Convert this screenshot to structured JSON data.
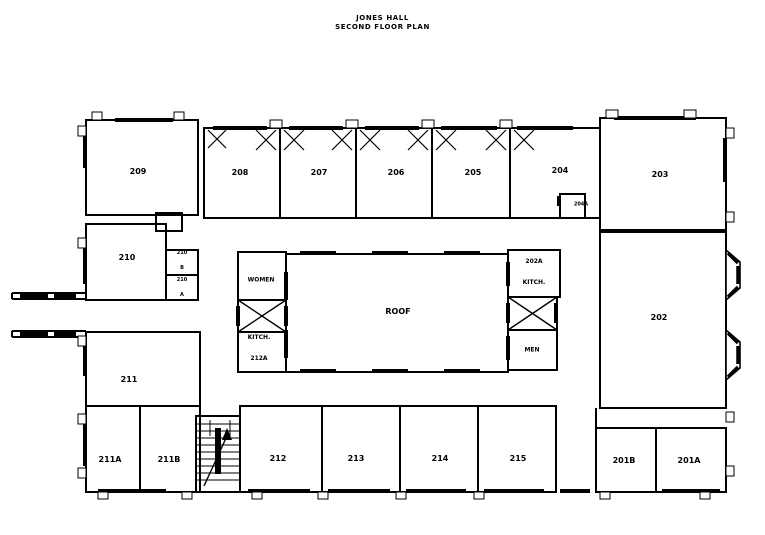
{
  "title": {
    "line1": "JONES HALL",
    "line2": "SECOND FLOOR PLAN"
  },
  "rooms": {
    "209": "209",
    "208": "208",
    "207": "207",
    "206": "206",
    "205": "205",
    "204": "204",
    "204a": "204A",
    "203": "203",
    "202": "202",
    "210": "210",
    "211": "211",
    "211a": "211A",
    "211b": "211B",
    "212": "212",
    "213": "213",
    "214": "214",
    "215": "215",
    "201b": "201B",
    "201a": "201A"
  },
  "labels": {
    "roof": "ROOF",
    "women": "WOMEN",
    "men": "MEN",
    "kitch_s1": "KITCH.",
    "kitch_s2": "212A",
    "kitch_n1": "202A",
    "kitch_n2": "KITCH.",
    "c210b1": "210",
    "c210b2": "B",
    "c210a1": "210",
    "c210a2": "A"
  },
  "colors": {
    "ink": "#000000",
    "paper": "#ffffff"
  }
}
